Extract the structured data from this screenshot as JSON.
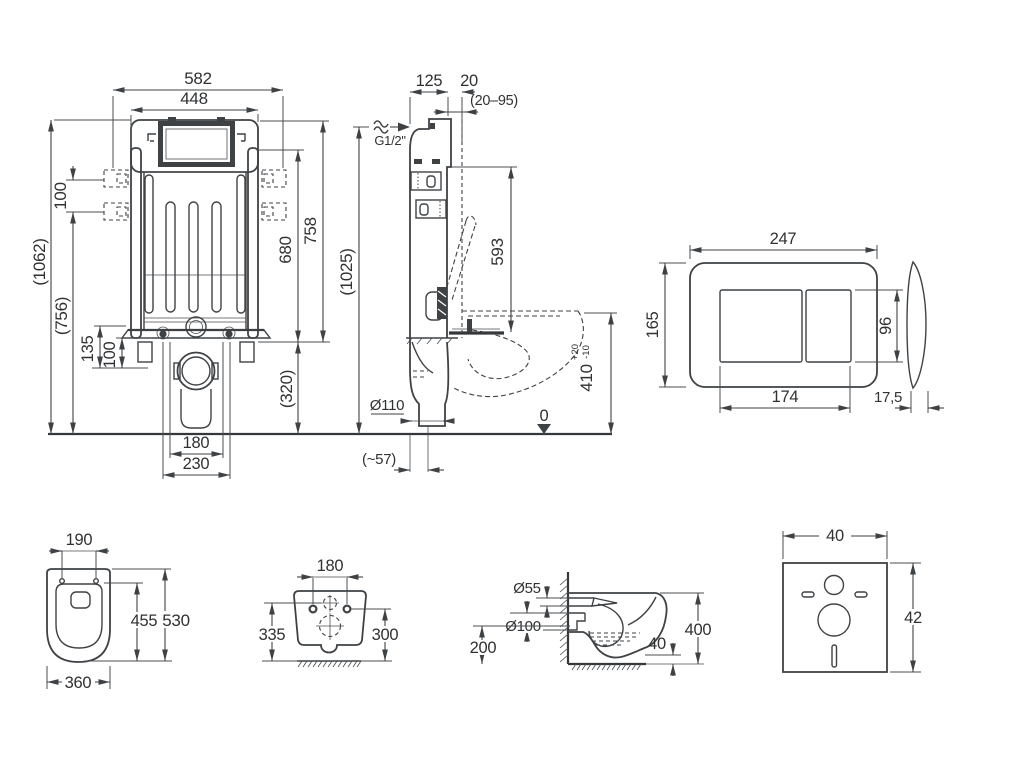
{
  "drawing": {
    "kind": "wall-hung WC installation set — dimensional technical drawing",
    "colors": {
      "line": "#3f4245",
      "text": "#2f3133",
      "background": "#ffffff"
    },
    "views": {
      "frame_front": {
        "title": "concealed cistern frame — front view",
        "dims": {
          "w582": "582",
          "w448": "448",
          "s100": "100",
          "h1062": "(1062)",
          "h756": "(756)",
          "d135": "135",
          "d100": "100",
          "h758": "758",
          "h680": "680",
          "h320": "(320)",
          "w180": "180",
          "w230": "230"
        }
      },
      "frame_side": {
        "title": "concealed cistern frame — side view",
        "dims": {
          "d125": "125",
          "d20": "20",
          "r2095": "(20–95)",
          "inlet": "G1/2\"",
          "h593": "593",
          "h1025": "(1025)",
          "h410": "410",
          "tol_plus": "+20",
          "tol_minus": "-10",
          "dia110": "Ø110",
          "off57": "(~57)",
          "zero": "0"
        }
      },
      "flush_plate": {
        "title": "flush push plate",
        "dims": {
          "w247": "247",
          "h165": "165",
          "h96": "96",
          "w174": "174",
          "t175": "17,5"
        }
      },
      "bowl_top": {
        "title": "WC bowl — top view",
        "dims": {
          "w190": "190",
          "l455": "455",
          "l530": "530",
          "w360": "360"
        }
      },
      "bowl_rear": {
        "title": "WC bowl — rear view",
        "dims": {
          "w180": "180",
          "h335": "335",
          "h300": "300"
        }
      },
      "bowl_side": {
        "title": "WC bowl — side view",
        "dims": {
          "d55": "Ø55",
          "d100": "Ø100",
          "h200": "200",
          "g40": "40",
          "h400": "400"
        }
      },
      "sound_pad": {
        "title": "sound insulation pad",
        "dims": {
          "w40": "40",
          "h42": "42"
        }
      }
    }
  }
}
